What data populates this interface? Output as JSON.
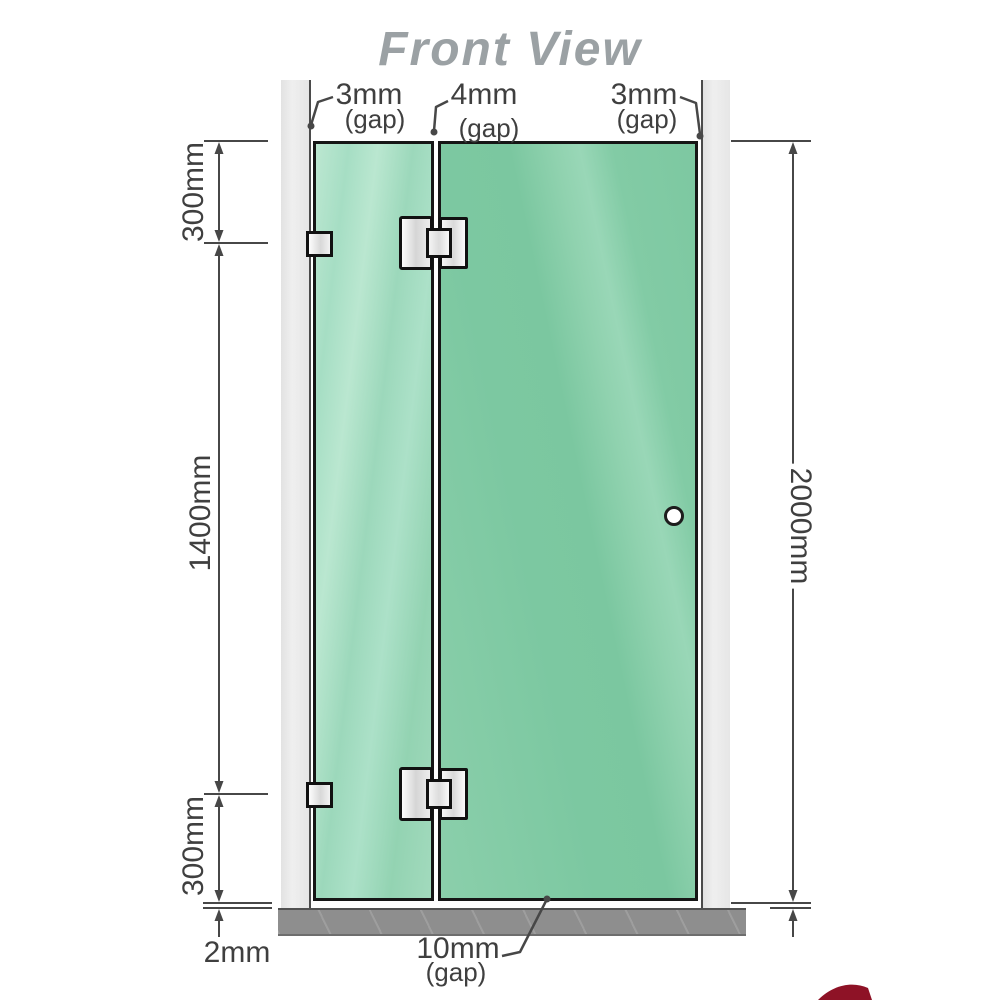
{
  "title": "Front View",
  "colors": {
    "glass": "#7cc8a1",
    "glass_light": "#b9e7d1",
    "wall": "#e9e9e9",
    "floor": "#8e8e8e",
    "line": "#474747",
    "title_text": "#9ba1a4",
    "hardware": "#e8e8e8",
    "logo_red": "#8e1226"
  },
  "dimensions": {
    "top_gaps": [
      {
        "value": "3mm",
        "qualifier": "(gap)"
      },
      {
        "value": "4mm",
        "qualifier": "(gap)"
      },
      {
        "value": "3mm",
        "qualifier": "(gap)"
      }
    ],
    "left": {
      "top_segment": "300mm",
      "middle_segment": "1400mm",
      "bottom_segment": "300mm",
      "floor_gap": "2mm"
    },
    "right": {
      "overall_height": "2000mm"
    },
    "bottom": {
      "value": "10mm",
      "qualifier": "(gap)"
    }
  }
}
